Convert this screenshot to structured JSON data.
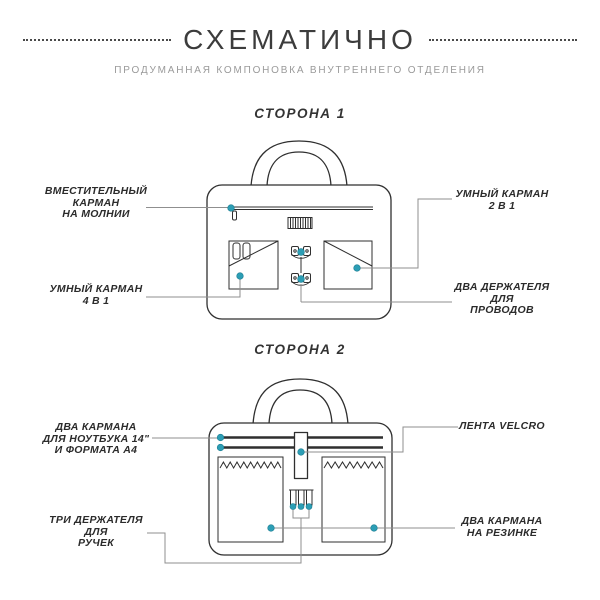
{
  "header": {
    "title": "СХЕМАТИЧНО",
    "subtitle": "ПРОДУМАННАЯ КОМПОНОВКА ВНУТРЕННЕГО ОТДЕЛЕНИЯ"
  },
  "colors": {
    "accent": "#2C9EB5",
    "ink": "#2F2F2F",
    "leader": "#8F8F8F"
  },
  "side1": {
    "heading": "СТОРОНА 1",
    "labels": {
      "zipper_pocket": {
        "lines": [
          "ВМЕСТИТЕЛЬНЫЙ",
          "КАРМАН",
          "НА МОЛНИИ"
        ]
      },
      "smart_pocket_4in1": {
        "lines": [
          "УМНЫЙ КАРМАН",
          "4 В 1"
        ]
      },
      "smart_pocket_2in1": {
        "lines": [
          "УМНЫЙ КАРМАН",
          "2 В 1"
        ]
      },
      "wire_holders": {
        "lines": [
          "ДВА ДЕРЖАТЕЛЯ",
          "ДЛЯ",
          "ПРОВОДОВ"
        ]
      }
    }
  },
  "side2": {
    "heading": "СТОРОНА 2",
    "labels": {
      "laptop_pockets": {
        "lines": [
          "ДВА КАРМАНА",
          "ДЛЯ НОУТБУКА 14\"",
          "И ФОРМАТА А4"
        ]
      },
      "pen_holders": {
        "lines": [
          "ТРИ ДЕРЖАТЕЛЯ",
          "ДЛЯ",
          "РУЧЕК"
        ]
      },
      "velcro": {
        "lines": [
          "ЛЕНТА VELCRO"
        ]
      },
      "elastic_pockets": {
        "lines": [
          "ДВА КАРМАНА",
          "НА РЕЗИНКЕ"
        ]
      }
    }
  }
}
